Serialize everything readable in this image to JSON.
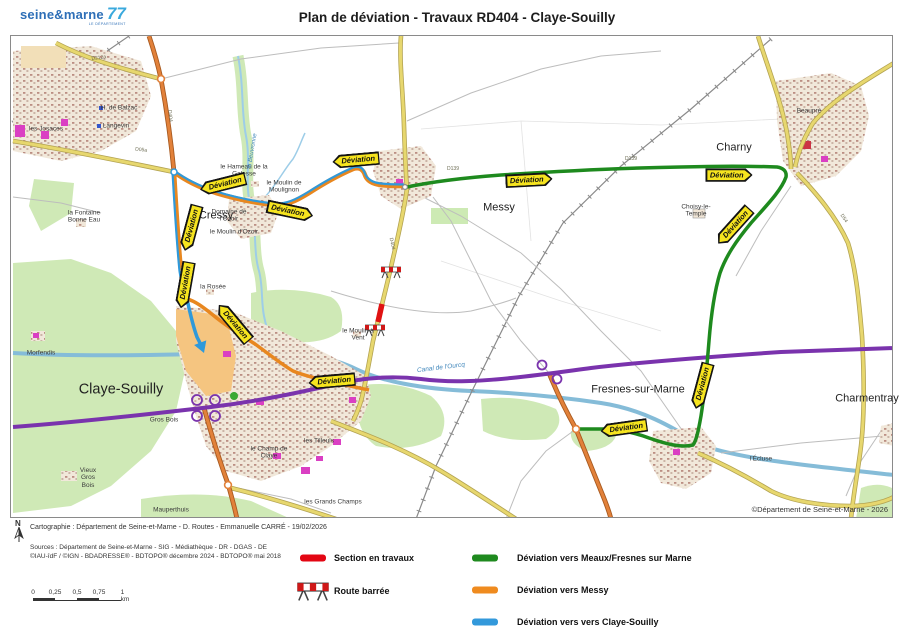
{
  "header": {
    "logo": {
      "name": "seine&marne",
      "number": "77",
      "subtitle": "LE DÉPARTEMENT"
    },
    "title": "Plan de déviation - Travaux RD404 - Claye-Souilly"
  },
  "map": {
    "badge_label": "Déviation",
    "copyright": "©Département de Seine-et-Marne - 2026",
    "towns": {
      "cressy": "Cressy",
      "messy": "Messy",
      "charny": "Charny",
      "claye": "Claye-Souilly",
      "fresnes": "Fresnes-sur-Marne",
      "charmentray": "Charmentray"
    },
    "places": {
      "balzac": "H. de Balzac",
      "langevin": "Langevin",
      "josaces": "les Josaces",
      "fontaine": "la Fontaine Bonne Eau",
      "hameau_galesse": "le Hameau de la Galesse",
      "moulin_moulignon": "le Moulin de Moulignon",
      "domaine_ozoir": "Domaine de l'Ozoir",
      "moulin_ozoir": "le Moulin d'Ozoir",
      "rosee": "la Rosée",
      "beuvronne": "la Beuvronne",
      "moulin_vent": "le Moulin à Vent",
      "canal": "Canal de l'Ourcq",
      "gros_bois": "Gros Bois",
      "vieux_gros_bois": "Vieux Gros Bois",
      "mauperthuis": "Mauperthuis",
      "champ_claye": "le Champ de Claye",
      "tilleuls": "les Tilleuls",
      "grands_champs": "les Grands Champs",
      "ecluse": "l'Écluse",
      "beaupre": "Beaupré",
      "choisy": "Choisy-le-Temple",
      "morfendis": "Morfendis"
    },
    "road_labels": {
      "d212a": "D212a",
      "d05a": "D05a",
      "d404": "D404",
      "d139": "D139",
      "d54": "D54"
    }
  },
  "footer": {
    "north_label": "N",
    "cartography": "Cartographie : Département de Seine-et-Marne - D. Routes - Emmanuelle CARRÉ - 19/02/2026",
    "sources_line1": "Sources : Département de Seine-et-Marne - SIG - Médiathèque - DR - DGAS - DE",
    "sources_line2": "©IAU-îdF / ©IGN - BDADRESSE® - BDTOPO® décembre 2024 - BDTOPO® mai 2018",
    "scale": {
      "ticks": [
        "0",
        "0,25",
        "0,5",
        "0,75",
        "1 km"
      ]
    },
    "legend": [
      {
        "id": "travaux",
        "label": "Section en travaux",
        "color": "#e30613"
      },
      {
        "id": "barree",
        "label": "Route barrée",
        "color": "#d01818"
      },
      {
        "id": "dev_meaux",
        "label": "Déviation vers Meaux/Fresnes sur Marne",
        "color": "#1f8a1f"
      },
      {
        "id": "dev_messy",
        "label": "Déviation vers Messy",
        "color": "#ef8b1f"
      },
      {
        "id": "dev_claye",
        "label": "Déviation vers vers Claye-Souilly",
        "color": "#3399db"
      }
    ]
  }
}
